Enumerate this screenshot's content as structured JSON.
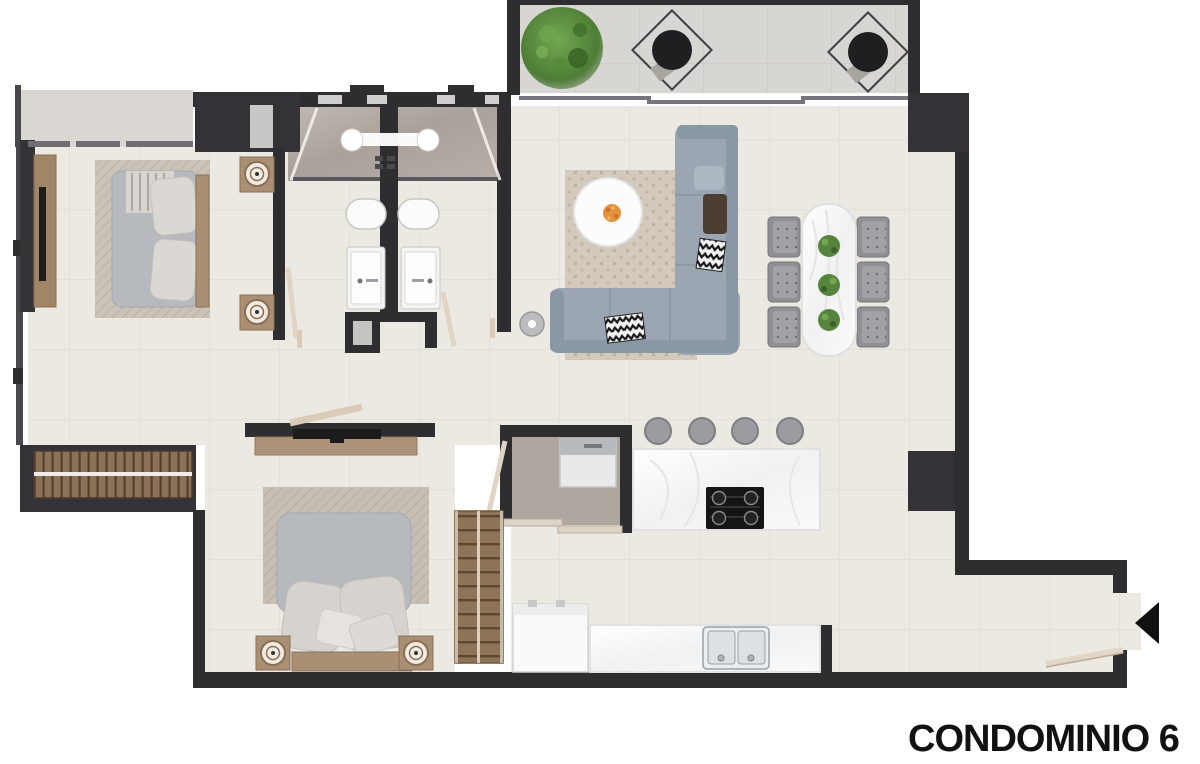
{
  "title": {
    "label": "CONDOMINIO 6"
  },
  "entry": {
    "arrow_icon": "entrance-arrow-left"
  },
  "colors": {
    "wall": "#2e2d30",
    "wall_soft": "#3a383c",
    "floor": "#ece8e2",
    "balcony_floor": "#d8d6d3",
    "shower_tile": "#b2aaa3",
    "closet_floor": "#aea79f",
    "wood": "#a98f74",
    "wood_dark": "#7c6142",
    "sofa": "#9ba6b2",
    "bed_linen": "#b6b9bd",
    "pillow": "#d9d5d0",
    "marble": "#f6f6f6",
    "chair_grey": "#929296",
    "plant_green": "#4e7d35",
    "title_text": "#111111"
  },
  "furniture_icons": [
    "double-bed",
    "nightstand-lamp",
    "tv-console",
    "wardrobe",
    "slatted-closet",
    "shower",
    "toilet",
    "sink-vanity",
    "l-shaped-sofa",
    "coffee-table",
    "area-rug",
    "dining-table",
    "dining-chair",
    "table-plant",
    "balcony-plant",
    "lounge-chair",
    "kitchen-island",
    "gas-cooktop",
    "bar-stool",
    "double-sink",
    "refrigerator",
    "washer",
    "floor-lamp",
    "door-leaf",
    "sliding-door"
  ]
}
